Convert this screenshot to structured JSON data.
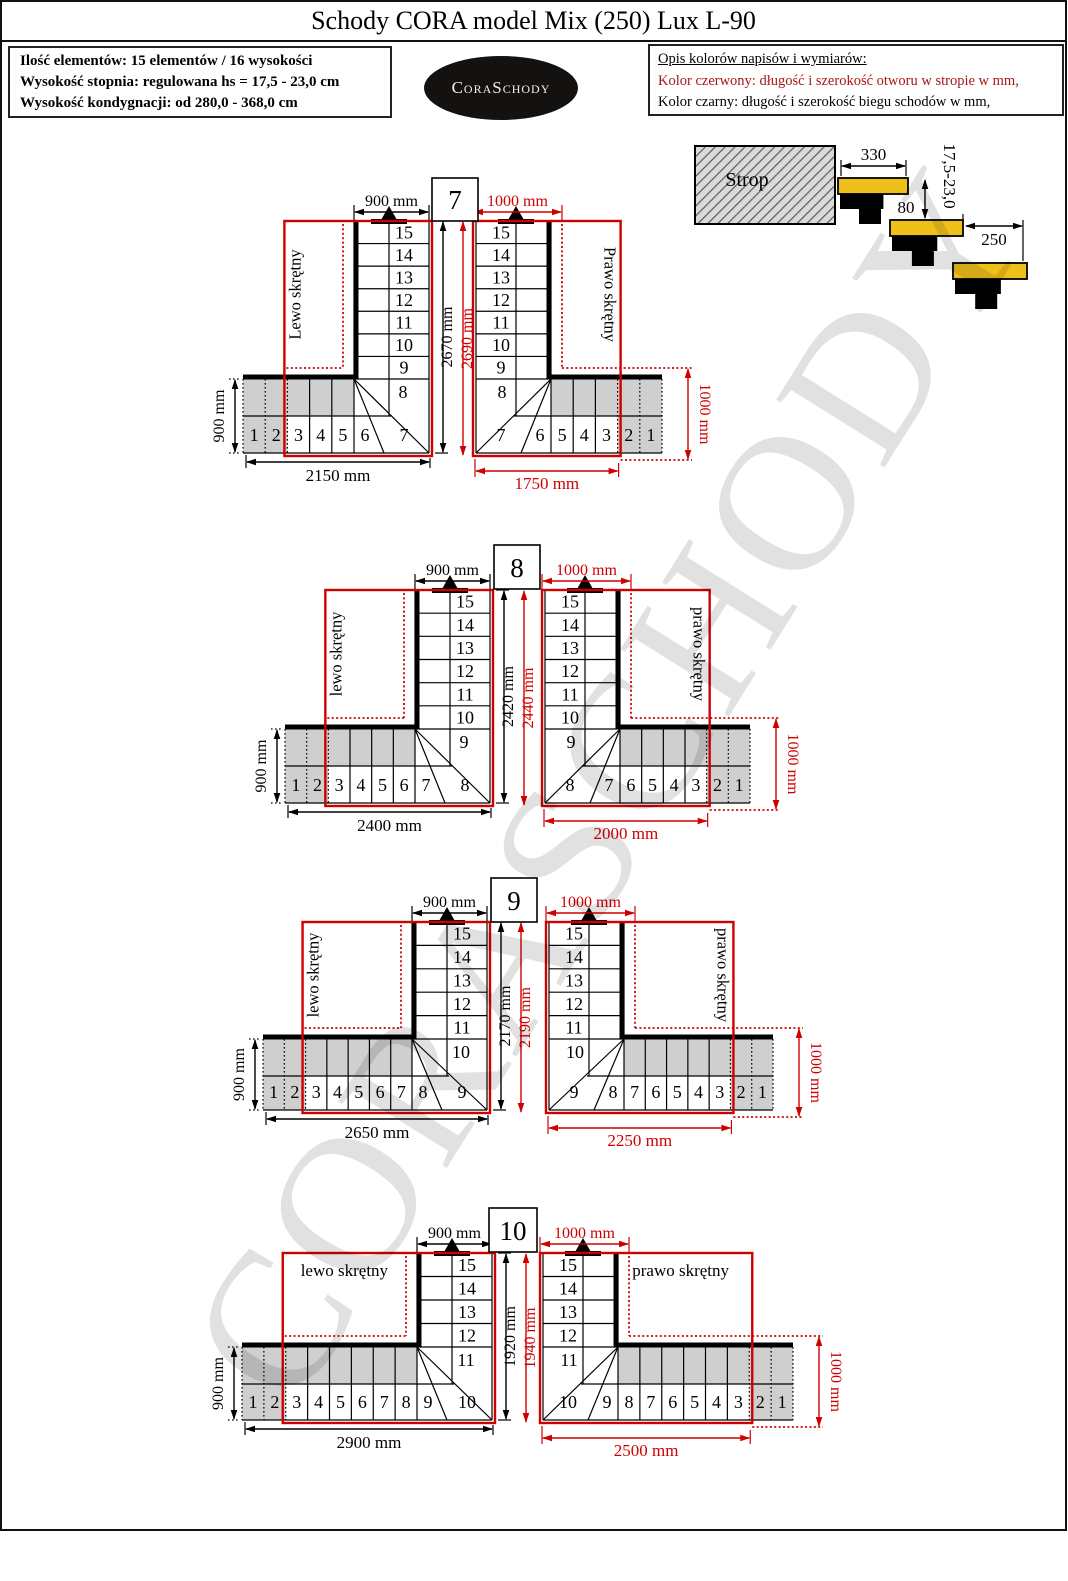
{
  "title": "Schody CORA model Mix (250) Lux L-90",
  "info_box": {
    "lines": [
      "Ilość elementów: 15 elementów / 16 wysokości",
      "Wysokość stopnia: regulowana  hs = 17,5 - 23,0 cm",
      "Wysokość kondygnacji: od 280,0 - 368,0 cm"
    ]
  },
  "logo_text": "CoraSchody",
  "legend": {
    "heading": "Opis kolorów napisów i wymiarów:",
    "red_line": "Kolor czerwony: długość i szerokość otworu w stropie w mm,",
    "black_line": "Kolor czarny: długość i szerokość biegu schodów w mm,"
  },
  "watermark": "CORASCHODY",
  "colors": {
    "dim_red": "#cf0000",
    "tread_yellow": "#f0c01a",
    "shade_gray": "#cfcfcf"
  },
  "side_view": {
    "strop_label": "Strop",
    "dim_330": "330",
    "dim_step_height": "17,5-23,0",
    "dim_80": "80",
    "dim_250": "250"
  },
  "groups": [
    {
      "id": "7",
      "left_label": "Lewo skrętny",
      "right_label": "Prawo skrętny",
      "label_orientation": "vertical",
      "run_width_dim": "900 mm",
      "opening_width_dim": "1000 mm",
      "run_height_dim": "2670 mm",
      "opening_height_dim": "2690 mm",
      "band_depth_dim": "900 mm",
      "run_length_dim": "2150 mm",
      "opening_length_dim": "1750 mm",
      "opening_side_dim": "1000 mm",
      "vertical_steps": [
        "15",
        "14",
        "13",
        "12",
        "11",
        "10",
        "9"
      ],
      "corner_step": "8",
      "winder_steps": [
        "6",
        "7"
      ],
      "straight_steps": [
        "1",
        "2",
        "3",
        "4",
        "5"
      ]
    },
    {
      "id": "8",
      "left_label": "lewo skrętny",
      "right_label": "prawo skrętny",
      "label_orientation": "vertical",
      "run_width_dim": "900 mm",
      "opening_width_dim": "1000 mm",
      "run_height_dim": "2420 mm",
      "opening_height_dim": "2440 mm",
      "band_depth_dim": "900 mm",
      "run_length_dim": "2400 mm",
      "opening_length_dim": "2000 mm",
      "opening_side_dim": "1000 mm",
      "vertical_steps": [
        "15",
        "14",
        "13",
        "12",
        "11",
        "10"
      ],
      "corner_step": "9",
      "winder_steps": [
        "7",
        "8"
      ],
      "straight_steps": [
        "1",
        "2",
        "3",
        "4",
        "5",
        "6"
      ]
    },
    {
      "id": "9",
      "left_label": "lewo skrętny",
      "right_label": "prawo skrętny",
      "label_orientation": "vertical",
      "run_width_dim": "900 mm",
      "opening_width_dim": "1000 mm",
      "run_height_dim": "2170 mm",
      "opening_height_dim": "2190 mm",
      "band_depth_dim": "900 mm",
      "run_length_dim": "2650 mm",
      "opening_length_dim": "2250 mm",
      "opening_side_dim": "1000 mm",
      "vertical_steps": [
        "15",
        "14",
        "13",
        "12",
        "11"
      ],
      "corner_step": "10",
      "winder_steps": [
        "8",
        "9"
      ],
      "straight_steps": [
        "1",
        "2",
        "3",
        "4",
        "5",
        "6",
        "7"
      ]
    },
    {
      "id": "10",
      "left_label": "lewo skrętny",
      "right_label": "prawo skrętny",
      "label_orientation": "horizontal",
      "run_width_dim": "900 mm",
      "opening_width_dim": "1000 mm",
      "run_height_dim": "1920 mm",
      "opening_height_dim": "1940 mm",
      "band_depth_dim": "900 mm",
      "run_length_dim": "2900 mm",
      "opening_length_dim": "2500 mm",
      "opening_side_dim": "1000 mm",
      "vertical_steps": [
        "15",
        "14",
        "13",
        "12"
      ],
      "corner_step": "11",
      "winder_steps": [
        "9",
        "10"
      ],
      "straight_steps": [
        "1",
        "2",
        "3",
        "4",
        "5",
        "6",
        "7",
        "8"
      ]
    }
  ]
}
